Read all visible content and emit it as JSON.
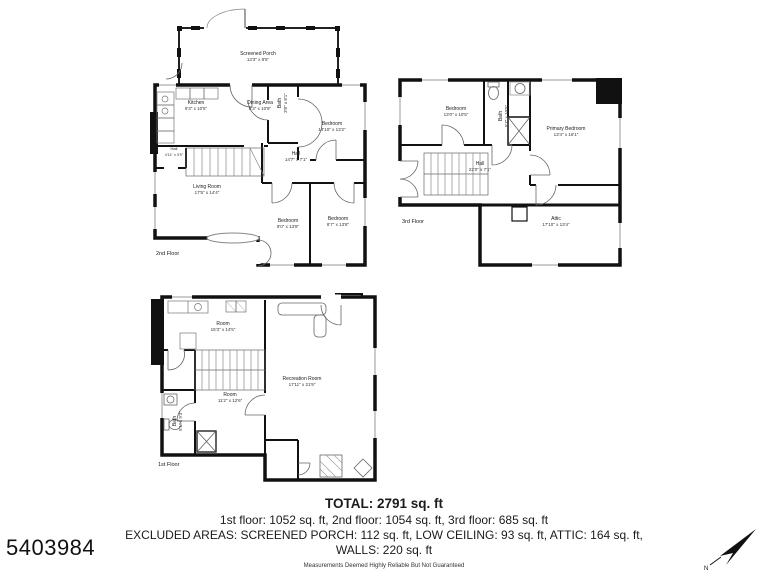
{
  "listing_id": "5403984",
  "compass": {
    "label": "N"
  },
  "floor2": {
    "label": "2nd Floor",
    "rooms": {
      "screened_porch": {
        "name": "Screened Porch",
        "dims": "13'3\" x 8'5\""
      },
      "kitchen": {
        "name": "Kitchen",
        "dims": "9'3\" x 10'5\""
      },
      "dining": {
        "name": "Dining Area",
        "dims": "8'3\" x 10'9\""
      },
      "bath": {
        "name": "Bath",
        "dims": "3'8\" x 8'1\""
      },
      "bedroom_right": {
        "name": "Bedroom",
        "dims": "14'10\" x 13'2\""
      },
      "hall": {
        "name": "Hall",
        "dims": "14'7\" x 7'1\""
      },
      "hall_small": {
        "name": "Hall",
        "dims": "4'11\" x 3'9\""
      },
      "living": {
        "name": "Living Room",
        "dims": "17'5\" x 14'4\""
      },
      "bedroom_left": {
        "name": "Bedroom",
        "dims": "9'0\" x 13'8\""
      },
      "bedroom_mid": {
        "name": "Bedroom",
        "dims": "8'7\" x 13'8\""
      }
    }
  },
  "floor3": {
    "label": "3rd Floor",
    "rooms": {
      "bedroom": {
        "name": "Bedroom",
        "dims": "13'0\" x 10'5\""
      },
      "bath": {
        "name": "Bath",
        "dims": "5'7\" x 10'5\""
      },
      "primary": {
        "name": "Primary Bedroom",
        "dims": "13'4\" x 16'1\""
      },
      "hall": {
        "name": "Hall",
        "dims": "22'0\" x 7'1\""
      },
      "attic": {
        "name": "Attic",
        "dims": "17'10\" x 13'4\""
      }
    }
  },
  "floor1": {
    "label": "1st Floor",
    "rooms": {
      "room_top": {
        "name": "Room",
        "dims": "15'3\" x 14'5\""
      },
      "rec_room": {
        "name": "Recreation Room",
        "dims": "17'11\" x 21'9\""
      },
      "room_mid": {
        "name": "Room",
        "dims": "11'2\" x 12'6\""
      },
      "bath": {
        "name": "Bath",
        "dims": "5'1\" x 9'3\""
      }
    }
  },
  "summary": {
    "total": "TOTAL: 2791 sq. ft",
    "floors_line": "1st floor: 1052 sq. ft, 2nd floor: 1054 sq. ft, 3rd floor: 685 sq. ft",
    "excluded_line": "EXCLUDED AREAS: SCREENED PORCH: 112 sq. ft, LOW CEILING: 93 sq. ft, ATTIC: 164 sq. ft,",
    "walls_line": "WALLS: 220 sq. ft",
    "disclaimer": "Measurements Deemed Highly Reliable But Not Guaranteed"
  }
}
